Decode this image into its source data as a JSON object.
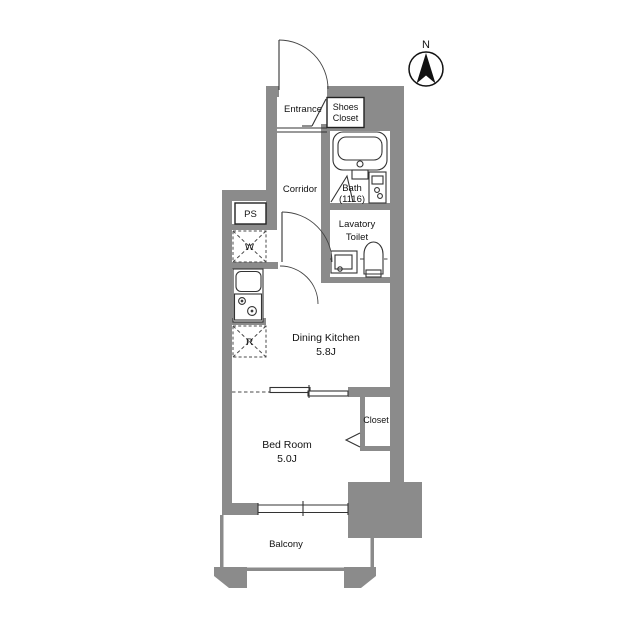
{
  "document_type": "apartment-floor-plan",
  "colors": {
    "wall": "#8b8b8b",
    "line": "#333333",
    "text": "#121212",
    "background": "#ffffff"
  },
  "compass": {
    "label": "N"
  },
  "rooms": {
    "entrance": {
      "label": "Entrance"
    },
    "shoes_closet": {
      "line1": "Shoes",
      "line2": "Closet"
    },
    "corridor": {
      "label": "Corridor"
    },
    "bath": {
      "label": "Bath",
      "size": "(1116)"
    },
    "pipe_space": {
      "label": "PS"
    },
    "washing_machine": {
      "label": "W"
    },
    "lavatory_toilet": {
      "line1": "Lavatory",
      "line2": "Toilet"
    },
    "refrigerator": {
      "label": "R"
    },
    "dining_kitchen": {
      "label": "Dining Kitchen",
      "size": "5.8J"
    },
    "closet": {
      "label": "Closet"
    },
    "bedroom": {
      "label": "Bed Room",
      "size": "5.0J"
    },
    "balcony": {
      "label": "Balcony"
    }
  }
}
